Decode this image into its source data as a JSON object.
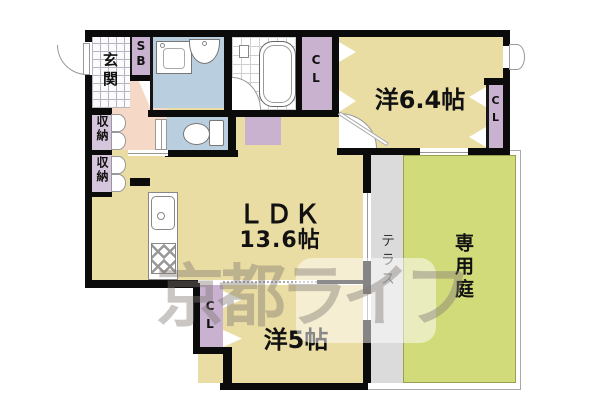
{
  "watermark": "京都ライフ",
  "rooms": {
    "genkan": {
      "label": "玄関"
    },
    "shoe_box": {
      "label": "SB"
    },
    "storage1": {
      "label": "収納"
    },
    "storage2": {
      "label": "収納"
    },
    "ldk": {
      "label": "ＬＤＫ",
      "area": "13.6帖"
    },
    "western64": {
      "label": "洋6.4帖"
    },
    "western5": {
      "label": "洋5帖"
    },
    "closet_west": {
      "label": "CL"
    },
    "closet_east": {
      "label": "CL"
    },
    "closet_south": {
      "label": "CL"
    },
    "terrace": {
      "label": "テラス"
    },
    "garden": {
      "label": "専用庭"
    }
  },
  "fixtures": [
    "washing-machine",
    "washbasin",
    "bathtub",
    "shower-mixer",
    "toilet",
    "kitchen-sink",
    "gas-stove"
  ],
  "colors": {
    "wall": "#0b0b0b",
    "room-beige": "#EADDA4",
    "hall-pink": "#F6D8C6",
    "wet-blue": "#B9CEDE",
    "closet-purple": "#C8B2D0",
    "storage-purple": "#D6C6DD",
    "terrace-gray": "#DBDBDB",
    "garden-green": "#D2DB7A"
  }
}
